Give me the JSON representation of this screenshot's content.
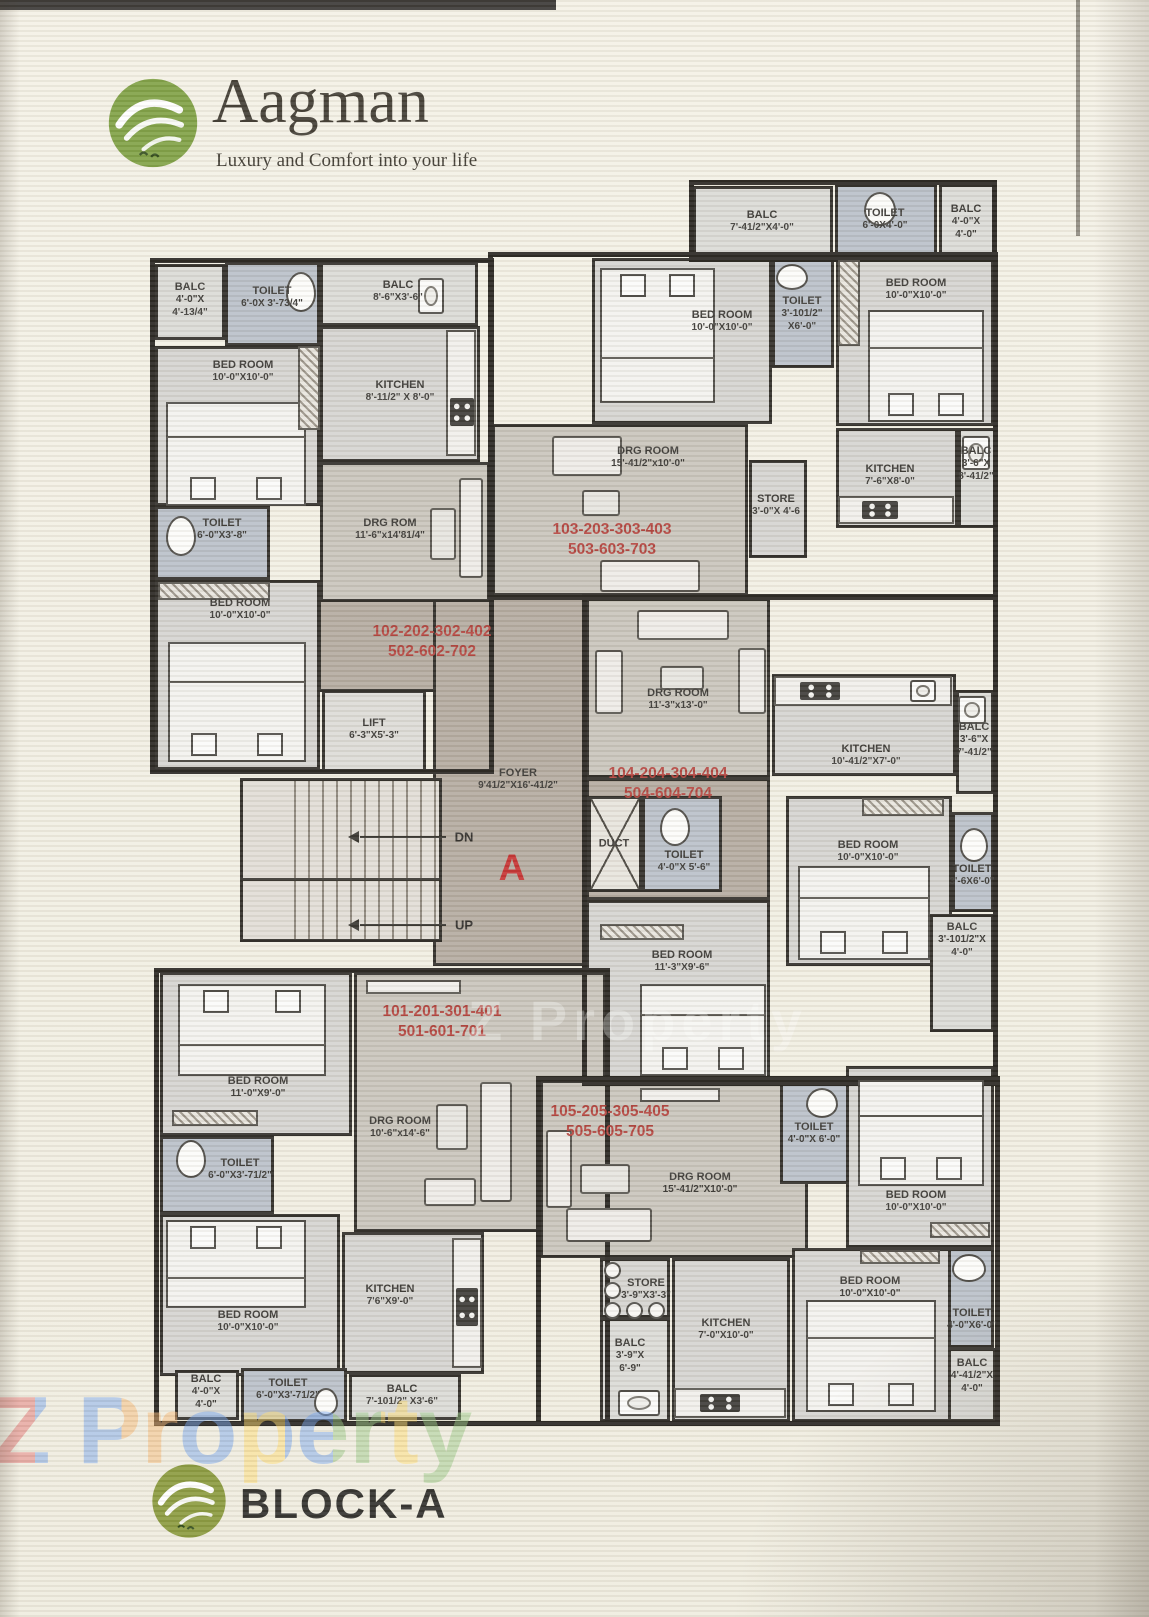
{
  "header": {
    "brand": "Aagman",
    "tagline": "Luxury and Comfort into your life"
  },
  "footer": {
    "block_label": "BLOCK-A"
  },
  "watermark": {
    "text": "Z Property"
  },
  "core": {
    "down_label": "DN",
    "up_label": "UP",
    "block_letter": "A"
  },
  "colors": {
    "unit_number_red": "#b2423c",
    "block_letter_red": "#c53030",
    "logo_green": "#7fa044"
  },
  "unit_numbers": {
    "u101": {
      "line1": "101-201-301-401",
      "line2": "501-601-701"
    },
    "u102": {
      "line1": "102-202-302-402",
      "line2": "502-602-702"
    },
    "u103": {
      "line1": "103-203-303-403",
      "line2": "503-603-703"
    },
    "u104": {
      "line1": "104-204-304-404",
      "line2": "504-604-704"
    },
    "u105": {
      "line1": "105-205-305-405",
      "line2": "505-605-705"
    }
  },
  "rooms": {
    "u102_balc1": {
      "name": "BALC",
      "dims": "4'-0\"X 4'-13/4\""
    },
    "u102_toilet1": {
      "name": "TOILET",
      "dims": "6'-0X 3'-73/4\""
    },
    "u102_bed1": {
      "name": "BED ROOM",
      "dims": "10'-0\"X10'-0\""
    },
    "u102_balc2": {
      "name": "BALC",
      "dims": "8'-6\"X3'-6\""
    },
    "u102_kitchen": {
      "name": "KITCHEN",
      "dims": "8'-11/2\" X 8'-0\""
    },
    "u102_toilet2": {
      "name": "TOILET",
      "dims": "6'-0\"X3'-8\""
    },
    "u102_bed2": {
      "name": "BED ROOM",
      "dims": "10'-0\"X10'-0\""
    },
    "u102_drg": {
      "name": "DRG ROM",
      "dims": "11'-6\"x14'81/4\""
    },
    "core_lift": {
      "name": "LIFT",
      "dims": "6'-3\"X5'-3\""
    },
    "core_foyer": {
      "name": "FOYER",
      "dims": "9'41/2\"X16'-41/2\""
    },
    "core_duct": {
      "name": "DUCT"
    },
    "core_toilet": {
      "name": "TOILET",
      "dims": "4'-0\"X 5'-6\""
    },
    "u103_balc1": {
      "name": "BALC",
      "dims": "7'-41/2\"X4'-0\""
    },
    "u103_toilet1": {
      "name": "TOILET",
      "dims": "6'-0X4'-0\""
    },
    "u103_balc2": {
      "name": "BALC",
      "dims": "4'-0\"X 4'-0\""
    },
    "u103_bed1": {
      "name": "BED ROOM",
      "dims": "10'-0\"X10'-0\""
    },
    "u103_toilet2": {
      "name": "TOILET",
      "dims": "3'-101/2\" X6'-0\""
    },
    "u103_bed2": {
      "name": "BED ROOM",
      "dims": "10'-0\"X10'-0\""
    },
    "u103_drg": {
      "name": "DRG ROOM",
      "dims": "15'-41/2\"x10'-0\""
    },
    "u103_store": {
      "name": "STORE",
      "dims": "3'-0\"X 4'-6"
    },
    "u103_kitchen": {
      "name": "KITCHEN",
      "dims": "7'-6\"X8'-0\""
    },
    "u103_balc3": {
      "name": "BALC",
      "dims": "3'-6\"X 8'-41/2\""
    },
    "u104_drg": {
      "name": "DRG ROOM",
      "dims": "11'-3\"x13'-0\""
    },
    "u104_kitchen": {
      "name": "KITCHEN",
      "dims": "10'-41/2\"X7'-0\""
    },
    "u104_balc1": {
      "name": "BALC",
      "dims": "3'-6\"X 7'-41/2\""
    },
    "u104_bed1": {
      "name": "BED ROOM",
      "dims": "10'-0\"X10'-0\""
    },
    "u104_toilet1": {
      "name": "TOILET",
      "dims": "3'-6X6'-0\""
    },
    "u104_balc2": {
      "name": "BALC",
      "dims": "3'-101/2\"X 4'-0\""
    },
    "u104_bed2": {
      "name": "BED ROOM",
      "dims": "11'-3\"X9'-6\""
    },
    "u101_bed1": {
      "name": "BED ROOM",
      "dims": "11'-0\"X9'-0\""
    },
    "u101_toilet1": {
      "name": "TOILET",
      "dims": "6'-0\"X3'-71/2\""
    },
    "u101_drg": {
      "name": "DRG ROOM",
      "dims": "10'-6\"x14'-6\""
    },
    "u101_bed2": {
      "name": "BED ROOM",
      "dims": "10'-0\"X10'-0\""
    },
    "u101_kitchen": {
      "name": "KITCHEN",
      "dims": "7'6\"X9'-0\""
    },
    "u101_balc1": {
      "name": "BALC",
      "dims": "4'-0\"X 4'-0\""
    },
    "u101_toilet2": {
      "name": "TOILET",
      "dims": "6'-0\"X3'-71/2\""
    },
    "u101_balc2": {
      "name": "BALC",
      "dims": "7'-101/2\" X3'-6\""
    },
    "u105_drg": {
      "name": "DRG ROOM",
      "dims": "15'-41/2\"X10'-0\""
    },
    "u105_toilet1": {
      "name": "TOILET",
      "dims": "4'-0\"X 6'-0\""
    },
    "u105_store": {
      "name": "STORE",
      "dims": "3'-9\"X3'-3\""
    },
    "u105_kitchen": {
      "name": "KITCHEN",
      "dims": "7'-0\"X10'-0\""
    },
    "u105_balc1": {
      "name": "BALC",
      "dims": "3'-9\"X 6'-9\""
    },
    "u105_bed1": {
      "name": "BED ROOM",
      "dims": "10'-0\"X10'-0\""
    },
    "u105_bed2": {
      "name": "BED ROOM",
      "dims": "10'-0\"X10'-0\""
    },
    "u105_toilet2": {
      "name": "TOILET",
      "dims": "4'-0\"X6'-0\""
    },
    "u105_balc2": {
      "name": "BALC",
      "dims": "4'-41/2\"X 4'-0\""
    }
  }
}
